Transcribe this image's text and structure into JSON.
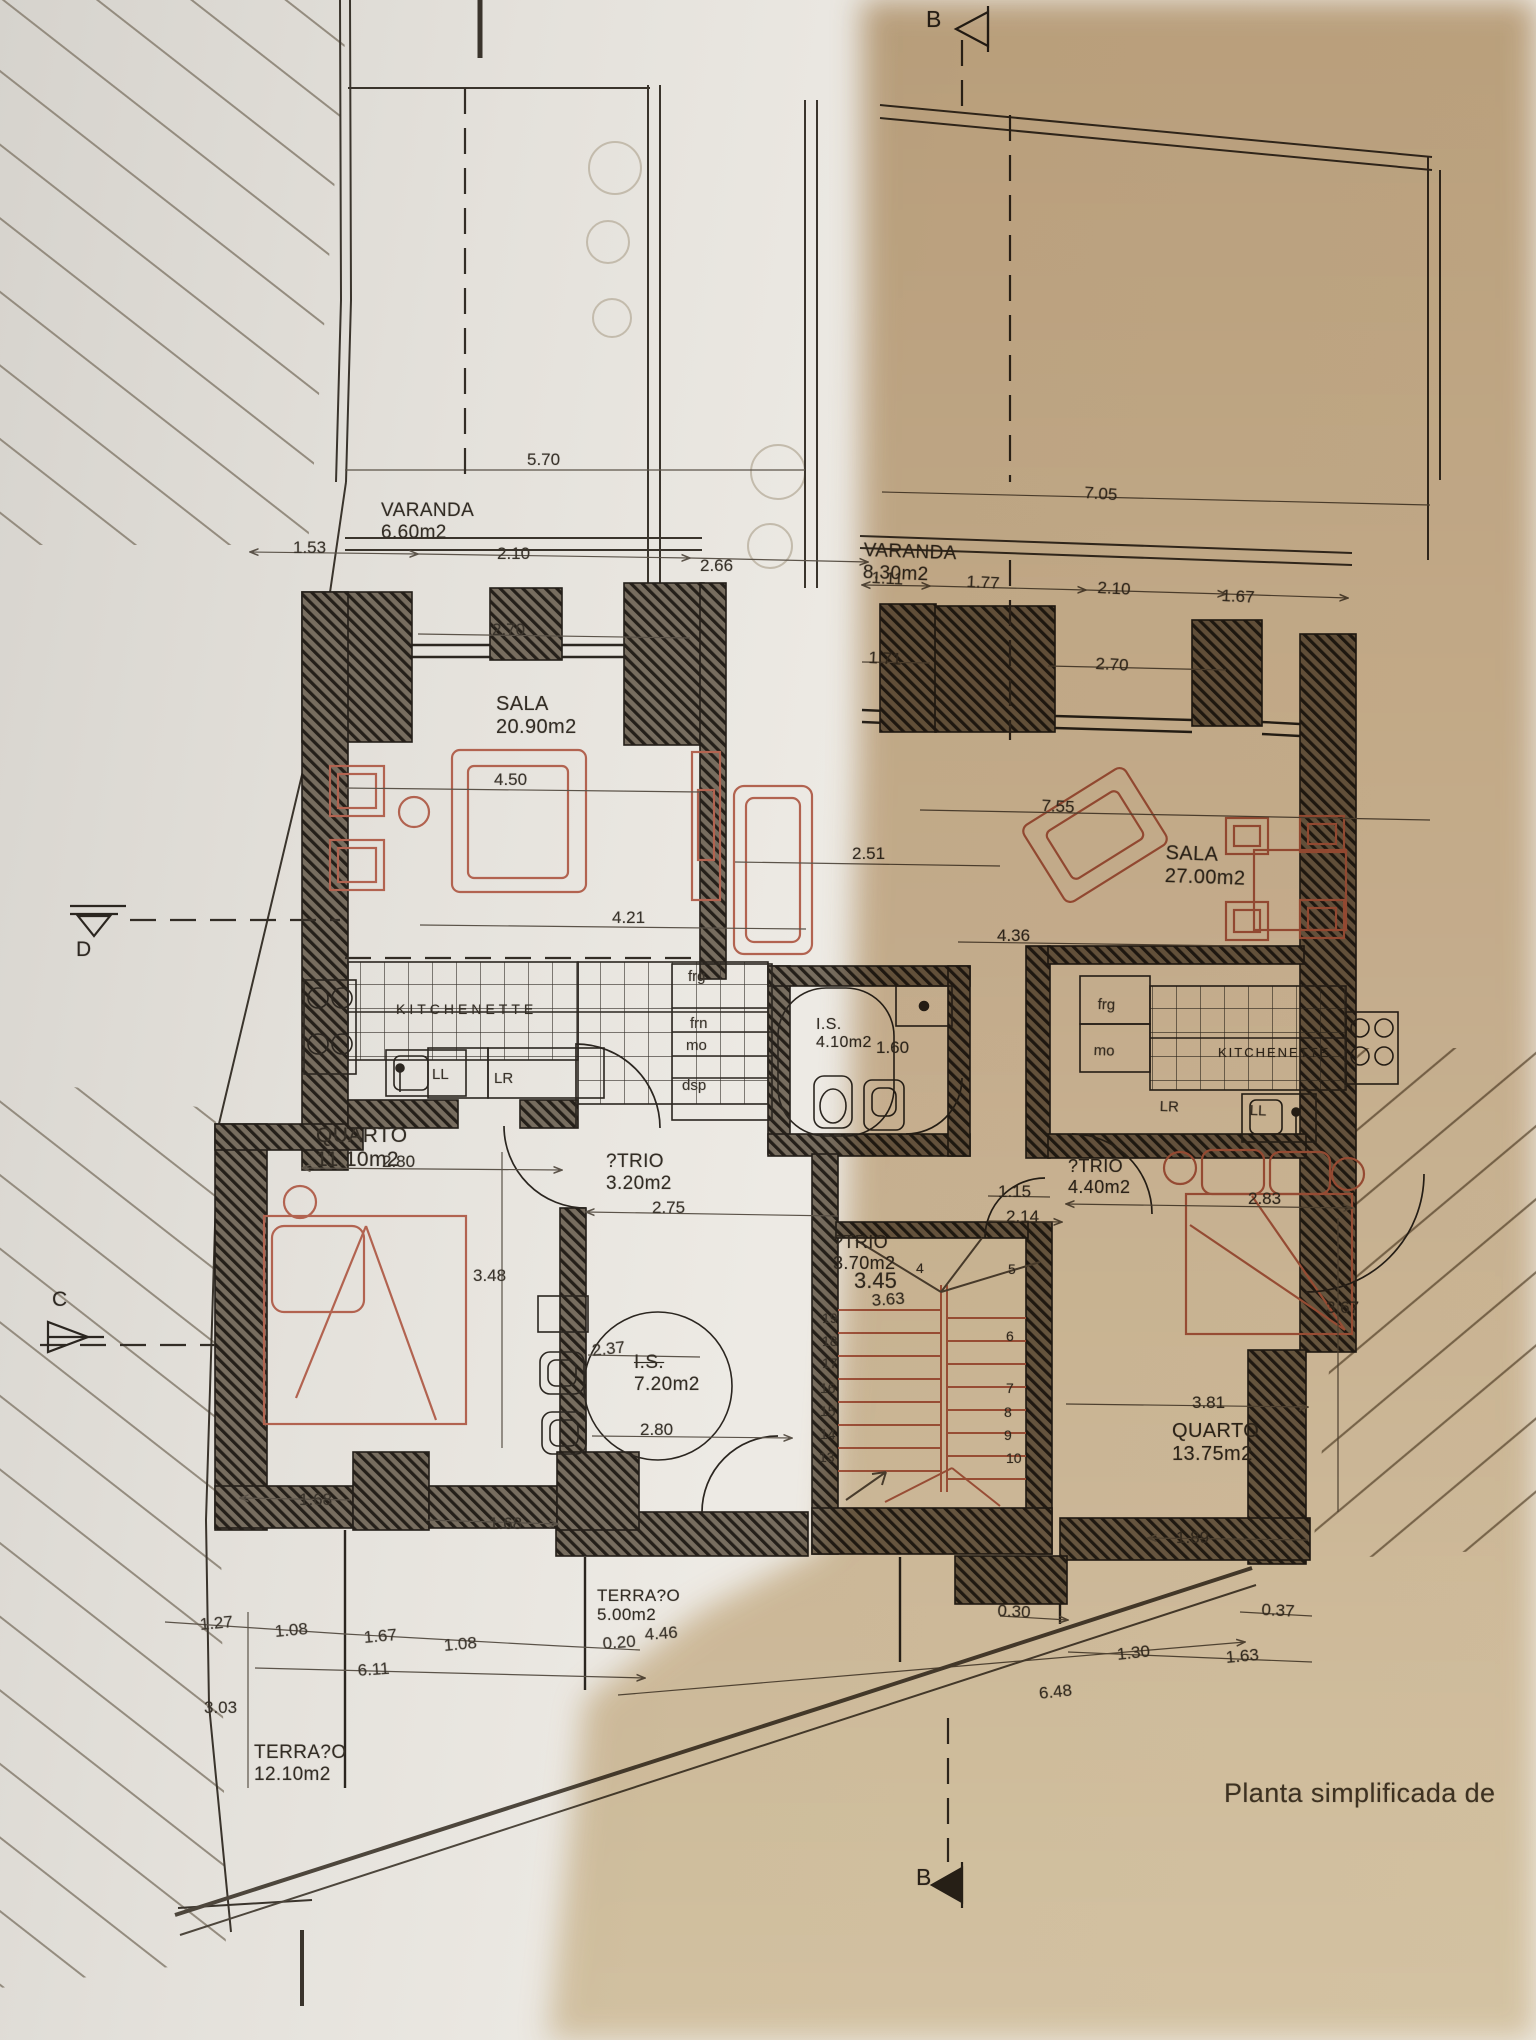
{
  "caption": {
    "text": "Planta simplificada de"
  },
  "sections": {
    "b_top": "B",
    "b_bottom": "B",
    "d": "D",
    "c": "C"
  },
  "colors": {
    "furniture": "#b26350",
    "wall_line": "#241f19",
    "paper_shadow": "#c9af8a",
    "dim_text": "#39332b"
  },
  "rooms": [
    {
      "n": "VARANDA",
      "a": "6.60m2",
      "x": 381,
      "y": 500,
      "fs": 19
    },
    {
      "n": "VARANDA",
      "a": "8.30m2",
      "x": 864,
      "y": 540,
      "fs": 19,
      "r": 2
    },
    {
      "n": "SALA",
      "a": "20.90m2",
      "x": 496,
      "y": 693,
      "fs": 20
    },
    {
      "n": "SALA",
      "a": "27.00m2",
      "x": 1166,
      "y": 842,
      "fs": 20,
      "r": 2
    },
    {
      "n": "QUARTO",
      "a": "11.10m2",
      "x": 316,
      "y": 1124,
      "fs": 21
    },
    {
      "n": "QUARTO",
      "a": "13.75m2",
      "x": 1172,
      "y": 1420,
      "fs": 20
    },
    {
      "n": "?TRIO",
      "a": "3.20m2",
      "x": 606,
      "y": 1151,
      "fs": 19
    },
    {
      "n": "?TRIO",
      "a": "4.40m2",
      "x": 1068,
      "y": 1156,
      "fs": 18
    },
    {
      "n": "?TRIO",
      "a": "3.70m2",
      "x": 833,
      "y": 1232,
      "fs": 18
    },
    {
      "n": "I.S.",
      "a": "4.10m2",
      "x": 816,
      "y": 1016,
      "fs": 16
    },
    {
      "n": "I.S.",
      "a": "7.20m2",
      "x": 634,
      "y": 1352,
      "fs": 19,
      "strike": true
    },
    {
      "n": "KITCHENETTE",
      "a": "",
      "x": 396,
      "y": 1002,
      "fs": 14,
      "ls": 4
    },
    {
      "n": "KITCHENETTE",
      "a": "",
      "x": 1218,
      "y": 1046,
      "fs": 13,
      "ls": 2
    },
    {
      "n": "TERRA?O",
      "a": "5.00m2",
      "x": 597,
      "y": 1586,
      "fs": 17
    },
    {
      "n": "TERRA?O",
      "a": "12.10m2",
      "x": 254,
      "y": 1742,
      "fs": 19
    }
  ],
  "dims": [
    {
      "t": "5.70",
      "x": 527,
      "y": 450
    },
    {
      "t": "7.05",
      "x": 1085,
      "y": 483,
      "r": 4
    },
    {
      "t": "1.53",
      "x": 293,
      "y": 538
    },
    {
      "t": "2.10",
      "x": 497,
      "y": 544
    },
    {
      "t": "2.66",
      "x": 700,
      "y": 556
    },
    {
      "t": "2.70",
      "x": 492,
      "y": 620
    },
    {
      "t": "1.11",
      "x": 872,
      "y": 568,
      "r": 3
    },
    {
      "t": "1.77",
      "x": 967,
      "y": 572,
      "r": 3
    },
    {
      "t": "2.10",
      "x": 1098,
      "y": 578,
      "r": 3
    },
    {
      "t": "1.67",
      "x": 1222,
      "y": 586,
      "r": 3
    },
    {
      "t": "1.71",
      "x": 869,
      "y": 648,
      "r": 3
    },
    {
      "t": "2.70",
      "x": 1096,
      "y": 654,
      "r": 3
    },
    {
      "t": "4.50",
      "x": 494,
      "y": 770
    },
    {
      "t": "7.55",
      "x": 1042,
      "y": 796,
      "r": 3
    },
    {
      "t": "2.51",
      "x": 852,
      "y": 844
    },
    {
      "t": "4.21",
      "x": 612,
      "y": 908
    },
    {
      "t": "4.36",
      "x": 997,
      "y": 926
    },
    {
      "t": "1.60",
      "x": 876,
      "y": 1038
    },
    {
      "t": "2.80",
      "x": 382,
      "y": 1152
    },
    {
      "t": "2.75",
      "x": 652,
      "y": 1198
    },
    {
      "t": "1.15",
      "x": 998,
      "y": 1182
    },
    {
      "t": "2.14",
      "x": 1006,
      "y": 1207
    },
    {
      "t": "2.83",
      "x": 1248,
      "y": 1189
    },
    {
      "t": "3.48",
      "x": 473,
      "y": 1266
    },
    {
      "t": "3.45",
      "x": 854,
      "y": 1268,
      "fs": 22
    },
    {
      "t": "3.63",
      "x": 871,
      "y": 1291,
      "r": -4
    },
    {
      "t": "2.37",
      "x": 591,
      "y": 1341,
      "r": -6
    },
    {
      "t": "2.80",
      "x": 640,
      "y": 1420
    },
    {
      "t": "3.67",
      "x": 1326,
      "y": 1298
    },
    {
      "t": "3.81",
      "x": 1192,
      "y": 1393
    },
    {
      "t": "1.68",
      "x": 299,
      "y": 1490
    },
    {
      "t": "1.68",
      "x": 489,
      "y": 1514
    },
    {
      "t": "1.89",
      "x": 1176,
      "y": 1528
    },
    {
      "t": "0.30",
      "x": 998,
      "y": 1601,
      "r": 3
    },
    {
      "t": "0.37",
      "x": 1262,
      "y": 1600,
      "r": 3
    },
    {
      "t": "4.46",
      "x": 644,
      "y": 1625,
      "r": -4
    },
    {
      "t": "0.20",
      "x": 602,
      "y": 1634,
      "r": -4
    },
    {
      "t": "1.27",
      "x": 199,
      "y": 1615,
      "r": -5
    },
    {
      "t": "1.08",
      "x": 274,
      "y": 1622,
      "r": -5
    },
    {
      "t": "1.67",
      "x": 363,
      "y": 1628,
      "r": -5
    },
    {
      "t": "1.08",
      "x": 443,
      "y": 1636,
      "r": -5
    },
    {
      "t": "6.11",
      "x": 357,
      "y": 1661,
      "r": -4
    },
    {
      "t": "1.30",
      "x": 1116,
      "y": 1645,
      "r": -6
    },
    {
      "t": "1.63",
      "x": 1225,
      "y": 1648,
      "r": -5
    },
    {
      "t": "6.48",
      "x": 1038,
      "y": 1684,
      "r": -6
    },
    {
      "t": "3.03",
      "x": 204,
      "y": 1698
    }
  ],
  "kitchen_labels": [
    {
      "t": "frg",
      "x": 688,
      "y": 968
    },
    {
      "t": "frn",
      "x": 690,
      "y": 1015
    },
    {
      "t": "mo",
      "x": 686,
      "y": 1037
    },
    {
      "t": "dsp",
      "x": 682,
      "y": 1077
    },
    {
      "t": "LL",
      "x": 432,
      "y": 1066
    },
    {
      "t": "LR",
      "x": 494,
      "y": 1070
    },
    {
      "t": "frg",
      "x": 1098,
      "y": 996,
      "r": 2
    },
    {
      "t": "mo",
      "x": 1094,
      "y": 1042,
      "r": 2
    },
    {
      "t": "LR",
      "x": 1160,
      "y": 1098,
      "r": 2
    },
    {
      "t": "LL",
      "x": 1250,
      "y": 1102,
      "r": 2
    }
  ],
  "stair_numbers": [
    {
      "t": "19",
      "x": 822,
      "y": 1310
    },
    {
      "t": "18",
      "x": 822,
      "y": 1333
    },
    {
      "t": "17",
      "x": 822,
      "y": 1355
    },
    {
      "t": "16",
      "x": 820,
      "y": 1380
    },
    {
      "t": "15",
      "x": 820,
      "y": 1403
    },
    {
      "t": "14",
      "x": 820,
      "y": 1426
    },
    {
      "t": "13",
      "x": 819,
      "y": 1449
    },
    {
      "t": "4",
      "x": 916,
      "y": 1260
    },
    {
      "t": "5",
      "x": 1008,
      "y": 1261
    },
    {
      "t": "6",
      "x": 1006,
      "y": 1328
    },
    {
      "t": "7",
      "x": 1006,
      "y": 1380
    },
    {
      "t": "8",
      "x": 1004,
      "y": 1404
    },
    {
      "t": "9",
      "x": 1004,
      "y": 1427
    },
    {
      "t": "10",
      "x": 1006,
      "y": 1450
    }
  ]
}
